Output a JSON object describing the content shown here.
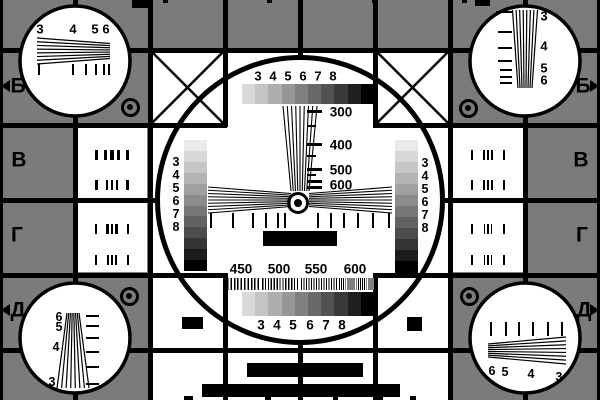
{
  "colors": {
    "background": "#7b7b7b",
    "ink": "#000000",
    "panel": "#ffffff",
    "gray_bar_steps": [
      "#d9d9d9",
      "#c4c4c4",
      "#aeaeae",
      "#979797",
      "#808080",
      "#696969",
      "#515151",
      "#393939",
      "#1f1f1f",
      "#000000"
    ],
    "stair_steps": [
      "#eaeaea",
      "#d8d8d8",
      "#c6c6c6",
      "#b3b3b3",
      "#a0a0a0",
      "#8c8c8c",
      "#777777",
      "#626262",
      "#4c4c4c",
      "#353535",
      "#1c1c1c",
      "#000000"
    ]
  },
  "title": {
    "name": "ТАБЛИЦА",
    "number": "0249",
    "suffix": "бис"
  },
  "edge_labels": {
    "left": [
      "Б",
      "В",
      "Г",
      "Д"
    ],
    "right": [
      "Б",
      "В",
      "Г",
      "Д"
    ]
  },
  "side_panels": {
    "left_values": [
      "200",
      "300",
      "350",
      "400"
    ],
    "right_values": [
      "450",
      "500",
      "550",
      "600"
    ]
  },
  "corner_circles": {
    "top_left": {
      "wedge_numbers": [
        "3",
        "4",
        "5",
        "6"
      ]
    },
    "top_right": {
      "wedge_numbers": [
        "3",
        "4",
        "5",
        "6"
      ]
    },
    "bottom_left": {
      "wedge_numbers": [
        "6",
        "5",
        "4",
        "3"
      ]
    },
    "bottom_right": {
      "wedge_numbers": [
        "6",
        "5",
        "4",
        "3"
      ]
    }
  },
  "center_circle": {
    "top_bar_numbers": [
      "3",
      "4",
      "5",
      "6",
      "7",
      "8"
    ],
    "bottom_bar_numbers": [
      "3",
      "4",
      "5",
      "6",
      "7",
      "8"
    ],
    "left_stair_numbers": [
      "3",
      "4",
      "5",
      "6",
      "7",
      "8"
    ],
    "right_stair_numbers": [
      "3",
      "4",
      "5",
      "6",
      "7",
      "8"
    ],
    "frequency_scale_vertical": [
      "300",
      "400",
      "500",
      "600"
    ],
    "frequency_scale_bottom": [
      "450",
      "500",
      "550",
      "600"
    ]
  }
}
